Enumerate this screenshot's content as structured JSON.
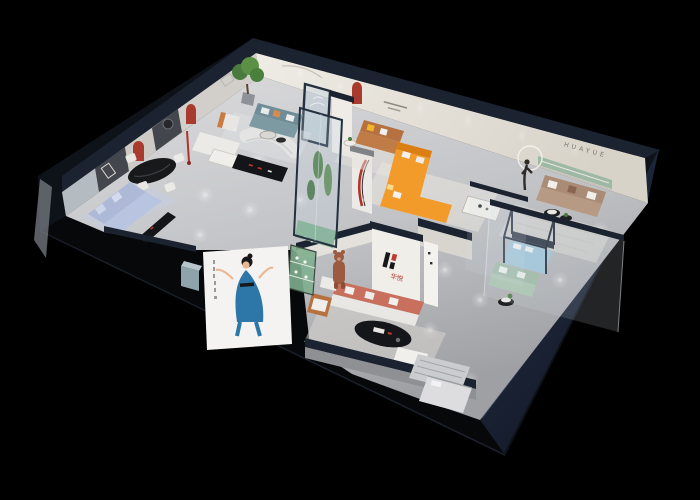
{
  "scene": {
    "type": "3D isometric furniture showroom cutaway render",
    "background": "#000000",
    "brand": {
      "mark": "H",
      "name_cn": "华悦",
      "wall_letters": "HUAYUE"
    },
    "palette": {
      "building_shell": "#0e1219",
      "right_facade_hi": "#263149",
      "right_facade_lo": "#141b28",
      "left_facade": "#060809",
      "wall_top_navy": "#1b2330",
      "wall_face_cream": "#e6e2da",
      "floor_light": "#d5d5d7",
      "floor_dark": "#a5a6aa",
      "accent_red": "#b03529",
      "niche_red": "#a93b2e",
      "sofa_orange": "#f29b2a",
      "sofa_caramel": "#b5713f",
      "sofa_coral": "#c96f5d",
      "sofa_periwinkle": "#aeb9d8",
      "sofa_teal": "#6e8d96",
      "sofa_green": "#9db8a4",
      "sofa_brown": "#a98b76",
      "bed_blue": "#9fc3d8",
      "plant_green": "#4a7a3e",
      "cabinet_green": "#7fae8e",
      "bear_brown": "#9c5b40",
      "poster_dress_blue": "#2d77a8",
      "logo_red": "#c0392b",
      "logo_black": "#17181a",
      "shelf_green": "#9db8a4"
    }
  }
}
